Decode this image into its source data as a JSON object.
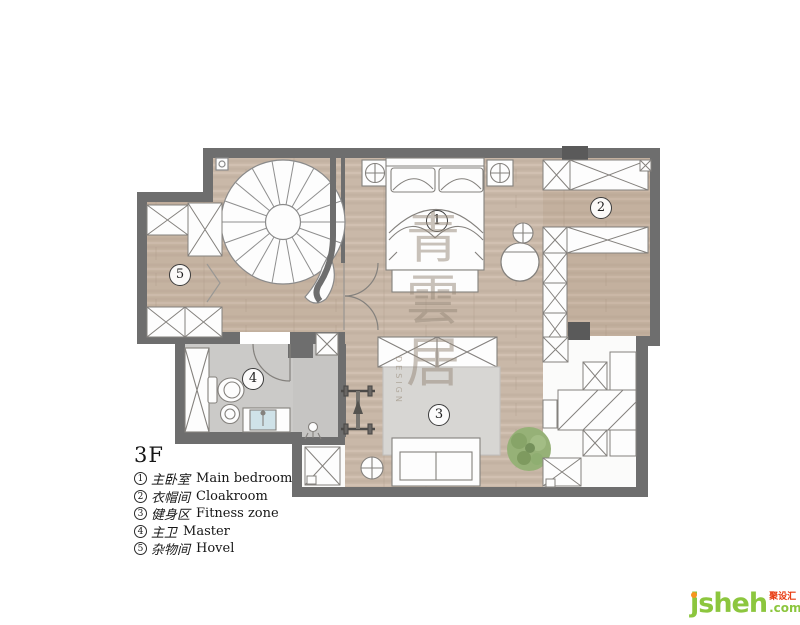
{
  "plan": {
    "room_numbers": [
      "1",
      "2",
      "3",
      "4",
      "5"
    ]
  },
  "legend": {
    "floor": "3F",
    "items": [
      {
        "num": "1",
        "cn": "主卧室",
        "en": "Main bedroom"
      },
      {
        "num": "2",
        "cn": "衣帽间",
        "en": "Cloakroom"
      },
      {
        "num": "3",
        "cn": "健身区",
        "en": "Fitness zone"
      },
      {
        "num": "4",
        "cn": "主卫",
        "en": "Master"
      },
      {
        "num": "5",
        "cn": "杂物间",
        "en": "Hovel"
      }
    ]
  },
  "watermark": {
    "chars": [
      "青",
      "雲",
      "居"
    ],
    "design": "DESIGN"
  },
  "logo": {
    "brand": "jsheh",
    "cn": "聚设汇",
    "tld": ".com"
  },
  "colors": {
    "wall": "#6e6e6e",
    "wall_dark": "#5a5a5a",
    "wood": "#c9b8a8",
    "tile": "#cbcac8",
    "mat": "#d7d6d3",
    "plant": "#96b177",
    "logo_green": "#8cc63e",
    "logo_orange": "#f7941e",
    "logo_red": "#e8380d"
  }
}
